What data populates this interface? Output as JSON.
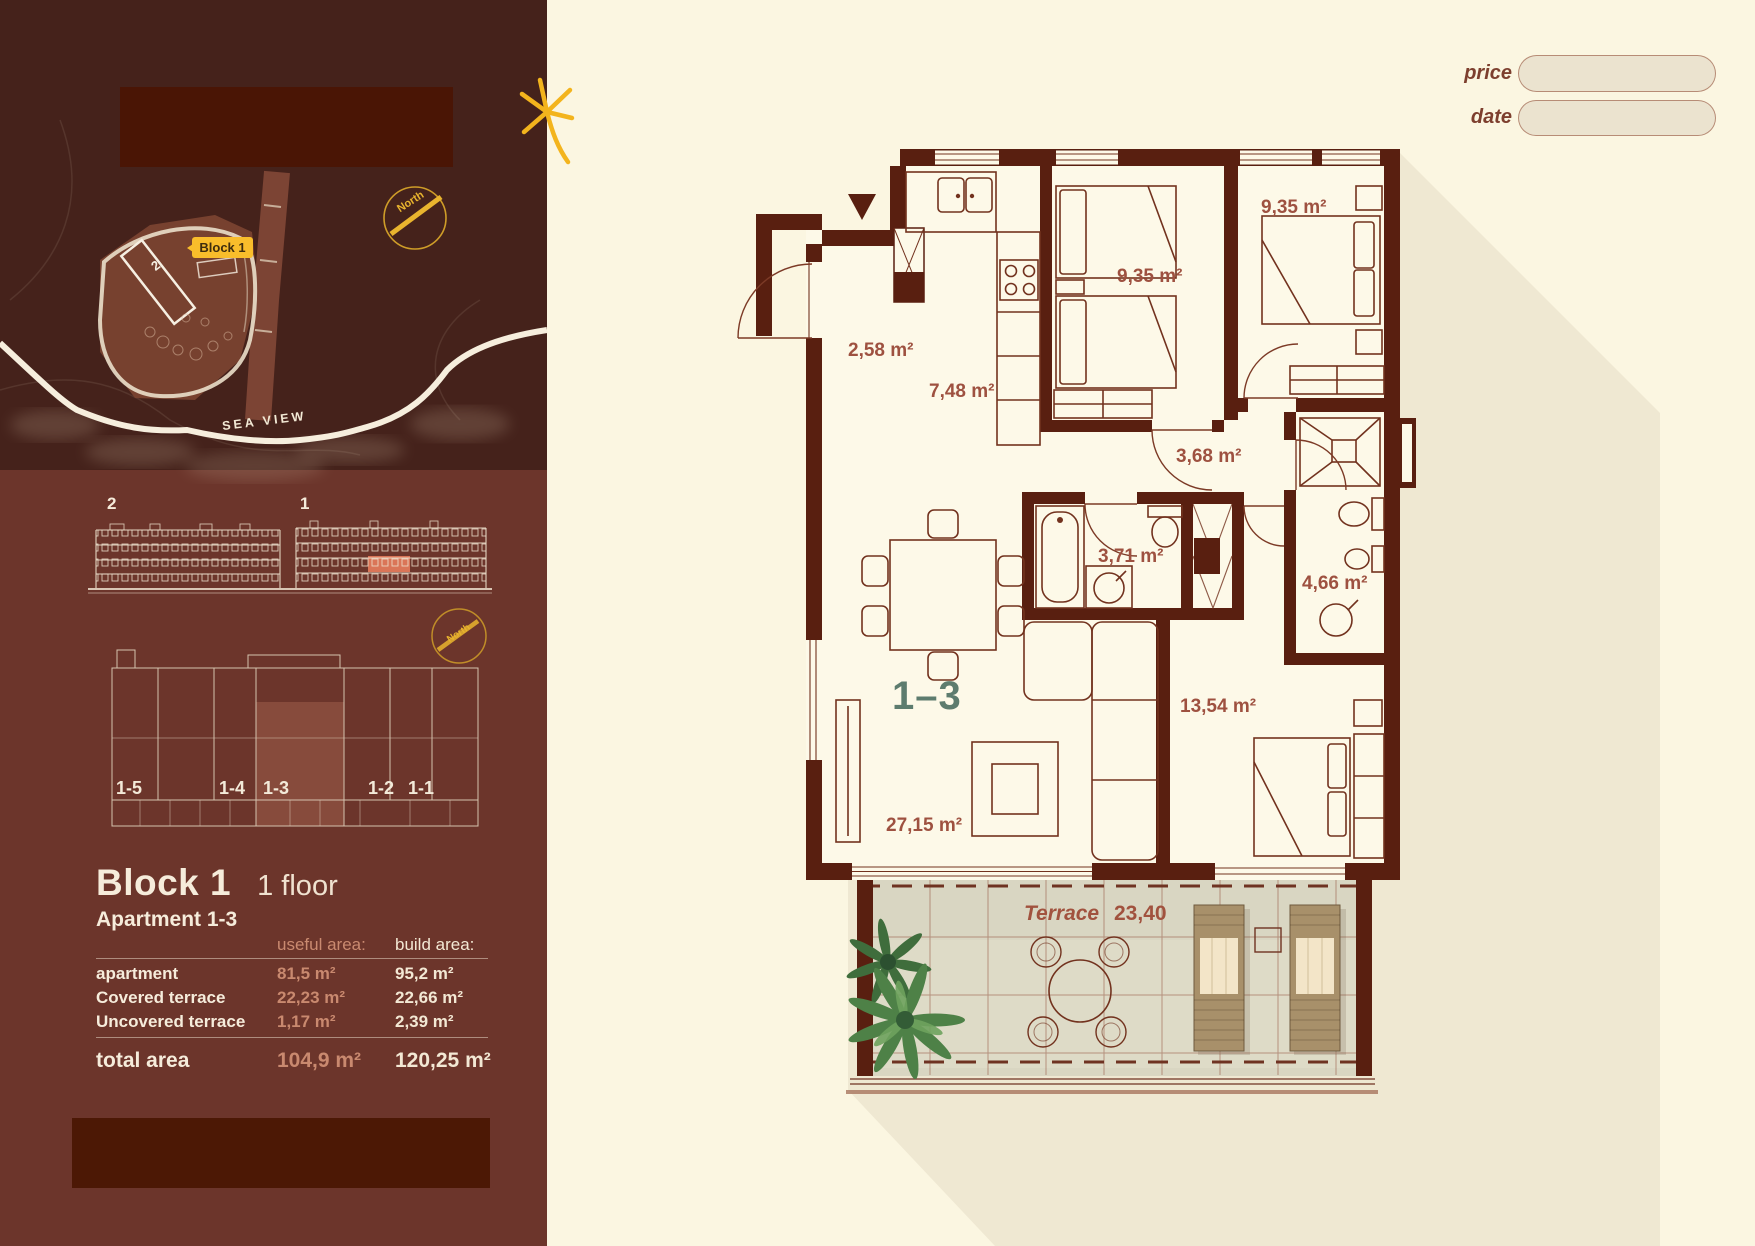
{
  "header": {
    "price_label": "price",
    "date_label": "date",
    "price_value": "",
    "date_value": ""
  },
  "sidebar": {
    "map": {
      "badge": "Block 1",
      "building_label": "2",
      "north": "North",
      "sea_view": "SEA VIEW"
    },
    "elevations": {
      "left_label": "2",
      "right_label": "1"
    },
    "overview": {
      "north": "North",
      "units": [
        "1-5",
        "1-4",
        "1-3",
        "1-2",
        "1-1"
      ]
    },
    "title": {
      "block": "Block 1",
      "floor": "1 floor",
      "apartment": "Apartment 1-3"
    },
    "area_table": {
      "useful_header": "useful area:",
      "build_header": "build area:",
      "rows": [
        {
          "label": "apartment",
          "useful": "81,5 m²",
          "build": "95,2 m²"
        },
        {
          "label": "Covered terrace",
          "useful": "22,23 m²",
          "build": "22,66 m²"
        },
        {
          "label": "Uncovered terrace",
          "useful": "1,17 m²",
          "build": "2,39 m²"
        }
      ],
      "total_label": "total area",
      "total_useful": "104,9 m²",
      "total_build": "120,25 m²"
    }
  },
  "plan": {
    "unit": "1–3",
    "rooms": {
      "hall": "2,58 m²",
      "kitchen": "7,48 m²",
      "bedroom1": "9,35 m²",
      "bedroom2": "9,35 m²",
      "corridor": "3,68 m²",
      "bathroom1": "3,71 m²",
      "bathroom2": "4,66 m²",
      "bedroom3": "13,54 m²",
      "living": "27,15 m²"
    },
    "terrace": {
      "label": "Terrace",
      "value": "23,40"
    }
  },
  "colors": {
    "page_cream": "#fbf6e1",
    "sidebar_maroon": "#6c352b",
    "map_maroon": "#45221b",
    "wall_maroon": "#591f10",
    "accent_yellow": "#f9bd2b",
    "salmon_text": "#c9896f",
    "room_label": "#9e5140",
    "unit_teal": "#5d7c6e",
    "highlight_salmon": "#e0795a",
    "shadow_beige": "#efe8d2",
    "terrace_tile": "#d9d6c2"
  }
}
